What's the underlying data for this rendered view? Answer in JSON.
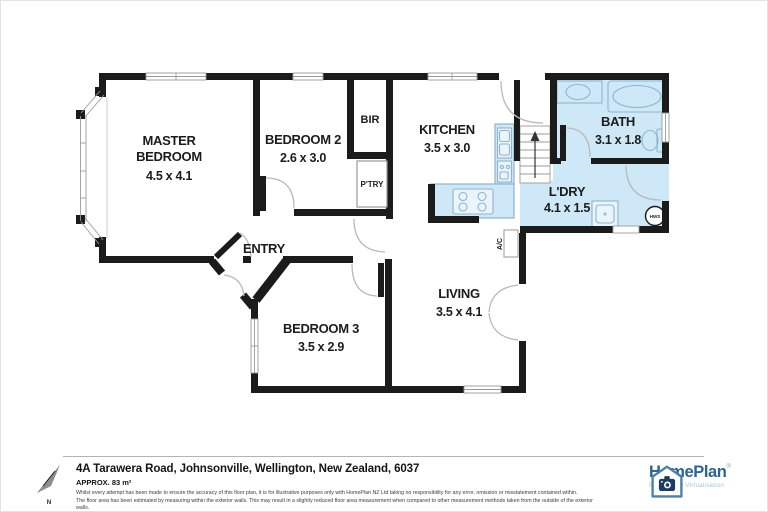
{
  "rooms": {
    "master": {
      "line1": "MASTER",
      "line2": "BEDROOM",
      "dims": "4.5 x 4.1"
    },
    "bedroom2": {
      "name": "BEDROOM 2",
      "dims": "2.6 x 3.0"
    },
    "bedroom3": {
      "name": "BEDROOM 3",
      "dims": "3.5 x 2.9"
    },
    "kitchen": {
      "name": "KITCHEN",
      "dims": "3.5 x 3.0"
    },
    "living": {
      "name": "LIVING",
      "dims": "3.5 x 4.1"
    },
    "bath": {
      "name": "BATH",
      "dims": "3.1 x 1.8"
    },
    "laundry": {
      "name": "L'DRY",
      "dims": "4.1 x 1.5"
    },
    "entry": {
      "name": "ENTRY"
    },
    "bir": {
      "name": "BIR"
    },
    "pantry": {
      "name": "P'TRY"
    }
  },
  "fixtures": {
    "ac_label": "A/C",
    "hws_label": "HWS"
  },
  "compass": {
    "north": "N"
  },
  "footer": {
    "address": "4A Tarawera Road, Johnsonville, Wellington, New Zealand, 6037",
    "area": "APPROX. 83 m²",
    "disclaimer_line1": "Whilst every attempt has been made to ensure the accuracy of this floor plan, it is for illustrative purposes only with HomePlan NZ Ltd taking no responsibility for any error, omission or misstatement contained within.",
    "disclaimer_line2": "The floor area has been estimated by measuring within the exterior walls. This may result in a slightly reduced floor area measurement when compared to other measurement methods taken from the outside of the exterior walls."
  },
  "logo": {
    "brand": "HomePlan",
    "registered": "®",
    "tagline": "Building 3D Virtualisation"
  },
  "colors": {
    "wall": "#1b1b1b",
    "wet_area_fill": "#cfe8f7",
    "fixture_stroke": "#8fb4cc",
    "brand_blue": "#2d6493",
    "tagline_blue": "#a6c6dc"
  }
}
